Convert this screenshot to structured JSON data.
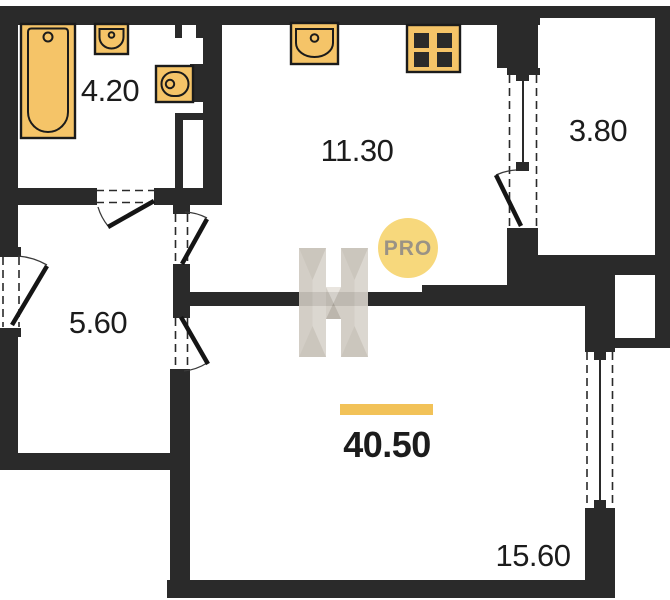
{
  "floor_plan": {
    "rooms": [
      {
        "id": "bathroom",
        "area": "4.20"
      },
      {
        "id": "kitchen",
        "area": "11.30"
      },
      {
        "id": "balcony",
        "area": "3.80"
      },
      {
        "id": "hallway",
        "area": "5.60"
      },
      {
        "id": "living-room",
        "area": "15.60"
      }
    ],
    "total_area": "40.50",
    "watermark": {
      "letter": "H",
      "badge": "PRO"
    }
  },
  "colors": {
    "wall": "#2a2a2a",
    "fixture": "#f5c468",
    "fixtureStroke": "#1b1b1b",
    "accentBar": "#f2c258",
    "badgeFill": "#f7d87c",
    "badgeText": "#9a9285",
    "labelText": "#1c1c1c",
    "wmBase": "#d8d3cb",
    "wmMid": "#cfc9c0",
    "wmDark": "#c6c0b6",
    "wmDarker": "#b5afa5",
    "wmLight": "#e7e3dc",
    "bg": "#ffffff"
  }
}
